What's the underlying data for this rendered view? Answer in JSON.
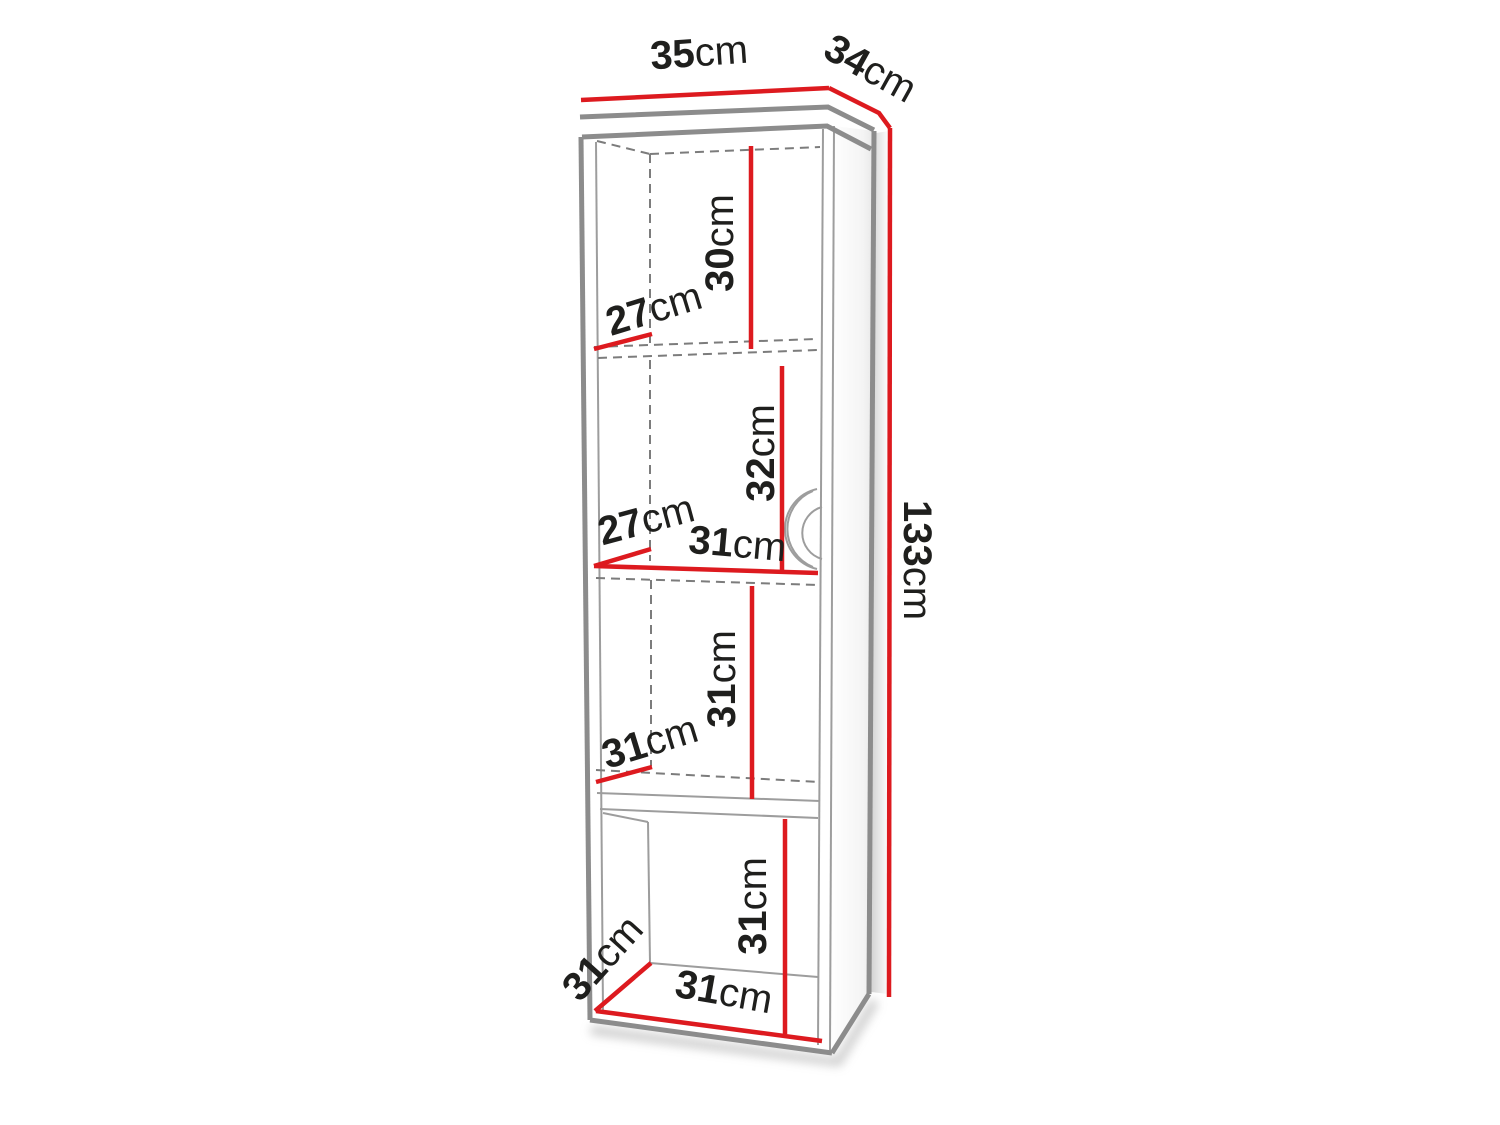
{
  "figure": {
    "type": "furniture-dimension-diagram",
    "subject": "tall-bookcase-with-door"
  },
  "colors": {
    "dimension_red": "#dd1a1f",
    "outline_gray": "#8c8c8c",
    "text_black": "#1f1f1d",
    "background": "#ffffff"
  },
  "dimensions": {
    "width_top": {
      "value": "35",
      "unit": "cm"
    },
    "depth_top": {
      "value": "34",
      "unit": "cm"
    },
    "height_total": {
      "value": "133",
      "unit": "cm"
    },
    "shelf1_height": {
      "value": "30",
      "unit": "cm"
    },
    "shelf1_depth": {
      "value": "27",
      "unit": "cm"
    },
    "shelf2_height": {
      "value": "32",
      "unit": "cm"
    },
    "shelf2_depth": {
      "value": "27",
      "unit": "cm"
    },
    "shelf2_width": {
      "value": "31",
      "unit": "cm"
    },
    "shelf3_height": {
      "value": "31",
      "unit": "cm"
    },
    "shelf3_depth": {
      "value": "31",
      "unit": "cm"
    },
    "shelf4_height": {
      "value": "31",
      "unit": "cm"
    },
    "shelf4_depth": {
      "value": "31",
      "unit": "cm"
    },
    "shelf4_width": {
      "value": "31",
      "unit": "cm"
    }
  }
}
